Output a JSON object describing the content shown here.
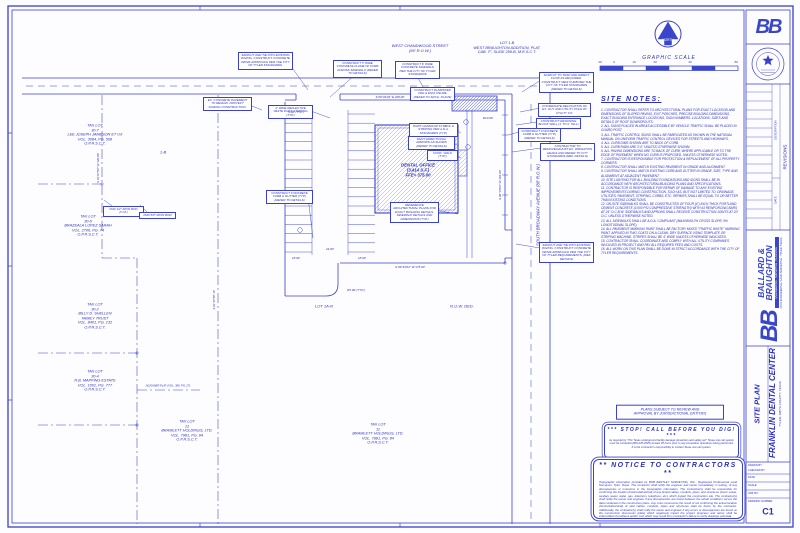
{
  "colors": {
    "line": "#3a41cc",
    "text": "#2b2fc0",
    "logo": "#3946cc",
    "hatch": "#97a3e0"
  },
  "compass": {
    "north_label": "NORTH"
  },
  "graphic_scale": {
    "title": "GRAPHIC SCALE"
  },
  "site_notes": {
    "title": "SITE NOTES:",
    "items": [
      "1.  CONTRACTOR SHALL REFER TO ARCHITECTURAL PLANS FOR EXACT LOCATION AND DIMENSIONS OF SLOPED PAVING, EXIT PORCHES, PRECISE BUILDING DIMENSIONS, EXACT BUILDING ENTRANCE LOCATIONS, SIGN NUMBERS, LOCATIONS, SIZES AND DETAILS OF ROOF DOWNSPOUTS.",
      "2.  ALL SIGNS PLACED IN AREAS ACCESSIBLE BY VEHICLE TRAFFIC SHALL BE PLACED IN GUARD POST.",
      "3.  ALL TRAFFIC CONTROL SIGNS SHALL BE FABRICATED AS SHOWN IN THE NATIONAL MANUAL ON UNIFORM TRAFFIC CONTROL DEVICES FOR STREETS AND HIGHWAYS.",
      "4.  ALL CURB DIMS SHOWN ARE TO BACK OF CURB.",
      "5.  ALL CURB RADII ARE 3'-0\" UNLESS OTHERWISE SHOWN.",
      "6.  ALL PAVING DIMENSIONS ARE TO BACK OF CURB, WHERE APPLICABLE OR TO THE EDGE OF PAVEMENT WHEN NO CURB IS PROPOSED, UNLESS OTHERWISE NOTED.",
      "7.  CONTRACTOR IS RESPONSIBLE FOR PROTECTION & REPLACEMENT OF ALL PROPERTY CORNERS.",
      "8.  CONTRACTOR SHALL MATCH EXISTING PAVEMENT IN GRADE AND ALIGNMENT.",
      "9.  CONTRACTOR SHALL MATCH EXISTING CURB AND GUTTER IN GRADE, SIZE, TYPE AND ALIGNMENT AT ADJACENT PAVEMENT.",
      "10. SITE LIGHTING FOR ALL BUILDING FOUNDATIONS AND SIGNS SHALL BE IN ACCORDANCE WITH ARCHITECTURAL/BUILDING PLANS AND SPECIFICATIONS.",
      "11. CONTRACTOR IS RESPONSIBLE FOR REPAIR OF DAMAGE TO ANY EXISTING IMPROVEMENTS DURING CONSTRUCTION, SUCH AS, BUT NOT LIMITED TO, DRAINAGE, UTILITIES, PAVEMENT, STRIPING, CURBS, ETC. REPAIRS SHALL BE EQUAL TO OR BETTER THAN EXISTING CONDITIONS.",
      "12. ON-SITE SIDEWALKS SHALL BE CONSTRUCTED OF FOUR (4\") INCH THICK PORTLAND CEMENT CONCRETE (3,000 PSI COMPRESSIVE STRENGTH) WITH #3 REINFORCING BARS AT 24\" O.C.B.W.  SIDEWALKS AND APRONS SHALL RECEIVE CONSTRUCTION JOINTS AT 20' O.C. UNLESS OTHERWISE NOTED.",
      "13. ALL SIDEWALKS SHALL BE A.D.A. COMPLIANT (MAXIMUM 2% CROSS SLOPE; 5% LONGITUDINAL SLOPE).",
      "14. ALL PAVEMENT MARKING PAINT SHALL BE FACTORY MIXED \"TRAFFIC WHITE\" MARKING PAINT, APPLIED IN TWO COATS ON A CLEAN, DRY SURFACE USING TEMPLATE OR STRIPING MACHINE.  STRIPES SHALL BE 4\" WIDE UNLESS OTHERWISE INDICATED.",
      "15. CONTRACTOR SHALL COORDINATE AND COMPLY WITH ALL UTILITY COMPANIES INVOLVED IN PROJECT AND PAY ALL REQUIRED FEES AND COSTS.",
      "16. ALL WORK ON THIS PLAN SHALL BE DONE IN STRICT ACCORDANCE WITH THE CITY OF TYLER REQUIREMENTS."
    ]
  },
  "boxes": {
    "plans_subject": "PLANS SUBJECT TO REVIEW AND\nAPPROVAL BY JURISDICTIONAL ENTITIES",
    "stop_dig": {
      "title": "***    STOP!  CALL BEFORE YOU DIG!    ***",
      "body": "As required by \"The Texas underground facility damage prevention and safety act\" Texas one call system must be contacted (800-245-4545) at least 48 hours prior to any excavation operations being performed.  It is the contractor's responsibility to contact Texas one call system."
    },
    "notice": {
      "title": "**     NOTICE  TO  CONTRACTORS     **",
      "body": "Topographic information provided by BOB BARTLEY SURVEYING, INC., Registered Professional Land Surveyors, Tyler, Texas.  The contractor shall notify the engineer and owner immediately, in writing, of any discrepancies or omissions in the topographic information.  The contractor(s) shall be responsible for confirming the location (horizontal/vertical) of any buried cables, conduits, pipes, and structures (storm sewer, sanitary sewer, water, gas, television, telephone, etc.) which impact the construction site.  The contractor(s) shall notify the owner and engineer if any discrepancies are found between the actual conditions versus the data contained in the construction plans.  Any costs incurred as the result of not confirming the actual location (horizontal/vertical) of said cables, conduits, pipes and structures shall be borne by the contractor.  Additionally, the contractor(s) shall notify the owner and engineer if any errors or discrepancies are found on the construction documents (plats) which negatively impact the project.  Engineer and owner shall be indemnified of problems and/or cost which may result from contractor's failure to verify drawings and data."
    }
  },
  "labels": {
    "street_top": "WEST CHANDWOOD STREET\n(60' R.O.W.)",
    "street_right": "SOUTH BROADWAY AVENUE  (80' R.O.W.)",
    "lot_1b": "LOT 1-B\nWEST BRAUGHTON ADDITION, PLAT,\nCAB. 'F', SLIDE 299-B, M.R.S.C.T.",
    "building": "DENTAL OFFICE\n(3,414 S.F.)\nFFE= 375.00",
    "lot_1ar": "LOT 1A-R",
    "row_ded": "R.O.W. DED.",
    "lot_strip": "1-B"
  },
  "tax_lots": [
    {
      "text": "TAX LOT\n30-7\nLEE JOSEPH JAMESON ET UX\nVOL. 3084, PG. 508\nO.P.R.S.C.T."
    },
    {
      "text": "TAX LOT\n30-6\nBRAZEALA LOPEZ SARAH\nVOL. 2706, PG. 74\nO.P.R.S.C.T."
    },
    {
      "text": "TAX LOT\n30-2\nBILLY D. SHELLEN\nFAMILY TRUST\nVOL. 8401, PG. 132\nO.P.R.S.C.T."
    },
    {
      "text": "TAX LOT\n30-4\nR.B. MAPPING ESTATE\nVOL. 1001, PG. 777\nO.P.R.S.C.T."
    },
    {
      "text": "TAX LOT\n12\nBRAMLETT HOLDINGS, LTD.\nVOL. 7981, PG. 84\nO.P.R.S.C.T."
    },
    {
      "text": "TAX LOT\n11\nBRAMLETT HOLDINGS, LTD.\nVOL. 7981, PG. 84\nO.P.R.S.C.T."
    }
  ],
  "callouts": [
    {
      "t": "SAWCUT AND TIE INTO EXISTING PAVING. CONSTRUCT CONCRETE DRIVE APPROACH PER THE CITY OF TYLER STANDARDS."
    },
    {
      "t": "CONSTRUCT 5' WIDE CONCRETE FLUME W/ CURB ACROSS SIDEWALK (REFER TO DETAILS)"
    },
    {
      "t": "CONSTRUCT 6' WIDE CONCRETE SIDEWALK PER THE CITY OF TYLER STANDARDS"
    },
    {
      "t": "SAWCUT TO TRAP AND DIRECT FLOW AS REQUIRED. CONSTRUCT NEW CURB PER THE CITY OF TYLER STANDARDS (REFER TO DETAILS)"
    },
    {
      "t": "EX. CONCRETE PAVEMENT TO REMAIN. PROTECT DURING CONSTRUCTION."
    },
    {
      "t": "4\" WIDE REFLECTIVE WHITE PAINT STRIPING (TYP.)"
    },
    {
      "t": "CONSTRUCT CONCRETE CURB & GUTTER (TYP.) (REFER TO DETAILS)"
    },
    {
      "t": "COORDINATE RELOCATION OF EX. GUY AND UTILITY POLE W/ UTILITY CO."
    },
    {
      "t": "CONSTRUCT RETAINING BLOCK WALL (1' TO 2' TALL)"
    },
    {
      "t": "CONSTRUCT CONCRETE CURB & GUTTER (TYP.) (REFER TO DETAILS)"
    },
    {
      "t": "CONTRACTOR TO REMOVE/ADJUST EX. IRRIGATION HEADS AND REFER TO CITY STANDARDS (REF. DETAILS)"
    },
    {
      "t": "PAINT HANDICAP SYMBOL & STRIPING PER A.D.A. STANDARDS (TYP.)"
    },
    {
      "t": "PAINT DIRECTIONAL ARROWS AS SHOWN (REFER TO DETAILS)"
    },
    {
      "t": "CONC. WALK (TYP.)"
    },
    {
      "t": "REFERENCE ARCHITECTURAL PLANS FOR EXACT BUILDING DETAILS, SIDEWALK DETAILS AND DIMENSIONS (TYP.)"
    },
    {
      "t": "SAWCUT AND TIE INTO EXISTING PAVING. CONSTRUCT CONCRETE DRIVE APPROACH PER THE CITY OF TYLER REQUIREMENTS. (REF. DETAILS)"
    },
    {
      "t": "CONSTRUCT DUMPSTER PAD & ENCLOSURE (REFER TO ARCH. PLANS)"
    },
    {
      "t": "FND 1/2\" IRON ROD (C.M.)"
    },
    {
      "t": "FND 5/8\" IRON ROD"
    }
  ],
  "dims": [
    {
      "t": "20"
    },
    {
      "t": "0"
    },
    {
      "t": "10"
    },
    {
      "t": "20"
    },
    {
      "t": "40"
    },
    {
      "t": "80"
    },
    {
      "t": "9.00' (TYP.)"
    },
    {
      "t": "24.00'"
    },
    {
      "t": "18.00'"
    },
    {
      "t": "18.00'"
    },
    {
      "t": "R10.00'"
    },
    {
      "t": "R5.00' (TYP.)"
    },
    {
      "t": "S 89°44'04\" E   208.00'"
    },
    {
      "t": "N 89°44'04\" W   175.00'"
    },
    {
      "t": "S 00°16'04\" W   165.00'"
    },
    {
      "t": "S 01°07'56\" W   120.00'"
    },
    {
      "t": "S 01°07'56\" W"
    },
    {
      "t": "ADJOINER PLAT (VOL. 389, PG. 27)"
    }
  ],
  "title_block": {
    "logo_initials": "BB",
    "revisions": {
      "title": "REVISIONS",
      "date": "DATE",
      "description": "DESCRIPTION"
    },
    "firm": {
      "name_line1": "BALLARD &",
      "name_line2": "BRAUGHTON",
      "tagline": "ENGINEERING  ·  SURVEYING  ·  PLANNING",
      "address": "CIVIL ENGINEERING / LAND SURVEYING · TYLER, TEXAS"
    },
    "project": {
      "name": "FRANKLIN DENTAL CENTER",
      "location": "TYLER, SMITH COUNTY, TEXAS",
      "sheet_title": "SITE PLAN"
    },
    "info": {
      "drawn_by": "DRAWN BY:",
      "checked_by": "CHECKED BY:",
      "date": "DATE:",
      "scale": "SCALE:",
      "job_no": "JOB NO.:",
      "drawing_number_label": "DRAWING NUMBER",
      "sheet_number": "C1"
    }
  }
}
